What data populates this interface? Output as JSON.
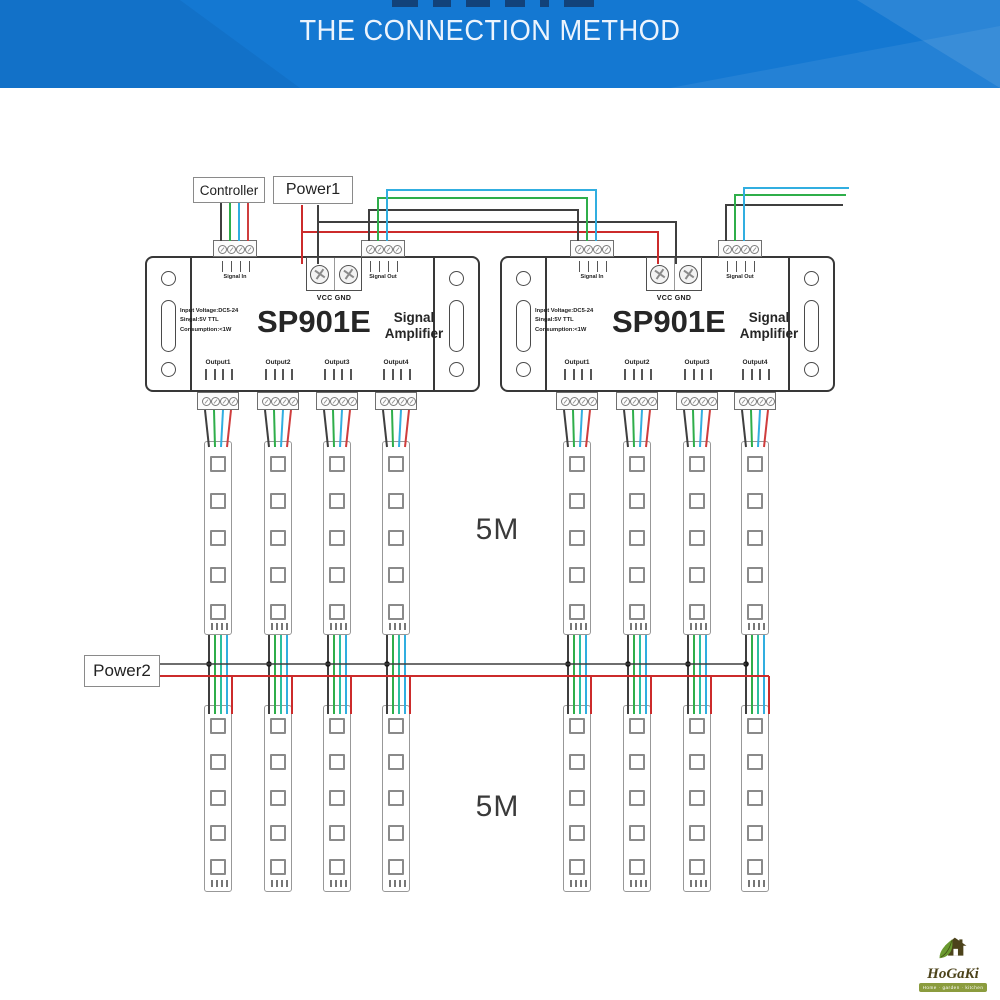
{
  "header": {
    "title": "THE CONNECTION METHOD"
  },
  "boxes": {
    "controller": "Controller",
    "power1": "Power1",
    "power2": "Power2"
  },
  "device": {
    "model": "SP901E",
    "type": "Signal Amplifier",
    "specs": [
      "Input Voltage:DC5-24",
      "Singal:5V TTL",
      "Consumption:<1W"
    ],
    "power_terminal": "VCC GND",
    "signal_in": "Signal In",
    "signal_out": "Signal Out",
    "outputs": [
      "Output1",
      "Output2",
      "Output3",
      "Output4"
    ]
  },
  "segments": {
    "top": "5M",
    "bottom": "5M"
  },
  "logo": {
    "name": "HoGaKi",
    "tagline": "Home · garden · kitchen"
  },
  "colors": {
    "header_blue": "#1478d2",
    "wire_black": "#3f3f3f",
    "wire_green": "#2fae4a",
    "wire_cyan": "#31aee0",
    "wire_teal": "#2cbf9f",
    "wire_red": "#cf3d3d",
    "power_red": "#cc2b2b"
  }
}
